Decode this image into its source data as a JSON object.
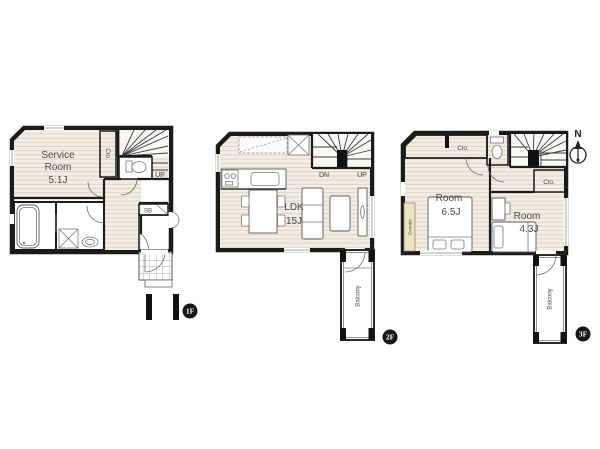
{
  "document": {
    "type": "floor-plan",
    "floors_count": 3
  },
  "colors": {
    "wall": "#1b1b1b",
    "wood_floor": "#f3ede4",
    "floor_stripe": "#dbd1c5",
    "closet_pink": "#f8d8cc",
    "wet_area_blue": "#daecf4",
    "counter_yellow": "#ece4ba",
    "tile_line": "#999999",
    "badge_black": "#151515"
  },
  "f1": {
    "badge": "1F",
    "service_room_line1": "Service",
    "service_room_line2": "Room",
    "service_room_size": "5.1J",
    "closet": "Clo.",
    "shoe_box": "SB",
    "stairs_up": "UP"
  },
  "f2": {
    "badge": "2F",
    "stairs_down": "DN",
    "stairs_up": "UP",
    "ldk": "LDK",
    "ldk_size": "15J",
    "balcony": "Balcony"
  },
  "f3": {
    "badge": "3F",
    "closet_top": "Clo.",
    "closet_right": "Clo.",
    "room_main": "Room",
    "room_main_size": "6.5J",
    "room_second": "Room",
    "room_second_size": "4.3J",
    "counter": "Counter",
    "balcony": "Balcony",
    "compass_north": "N"
  }
}
